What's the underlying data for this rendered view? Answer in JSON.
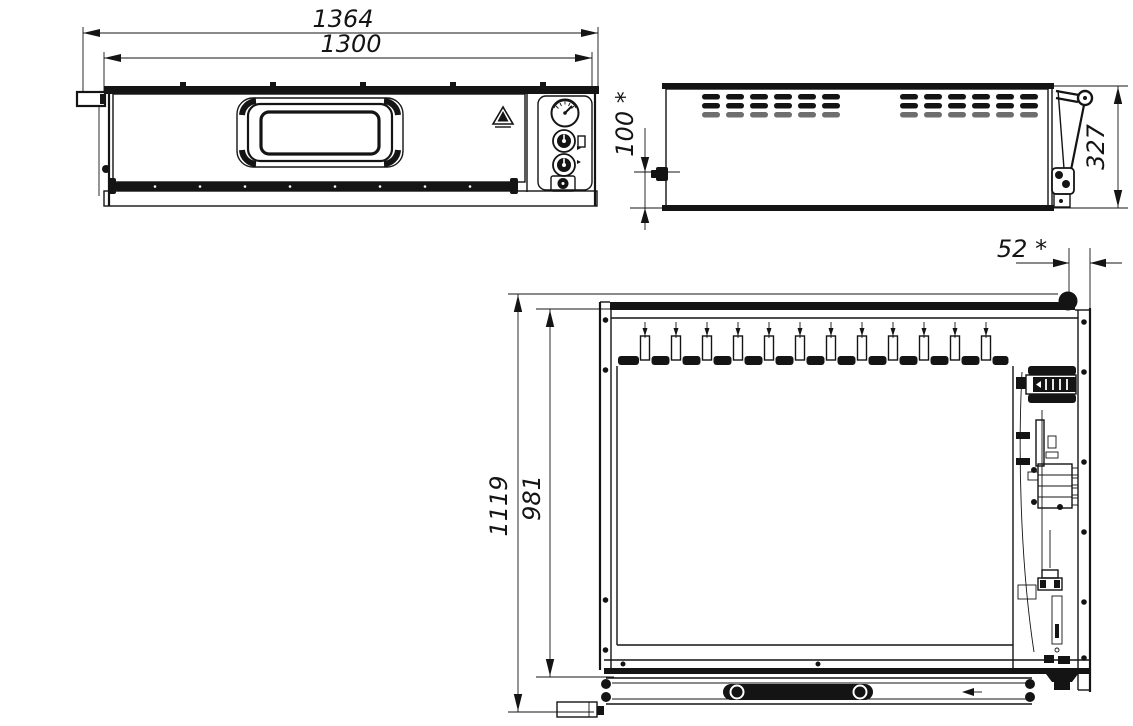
{
  "drawing": {
    "kind": "three-view technical drawing of a single-deck oven",
    "colors": {
      "line": "#141414",
      "background": "#ffffff"
    },
    "dimensions": {
      "overall_width": "1364",
      "door_width": "1300",
      "burner_offset": "100 *",
      "side_height": "327",
      "rear_gap": "52 *",
      "overall_depth": "1119",
      "body_depth": "981"
    }
  }
}
